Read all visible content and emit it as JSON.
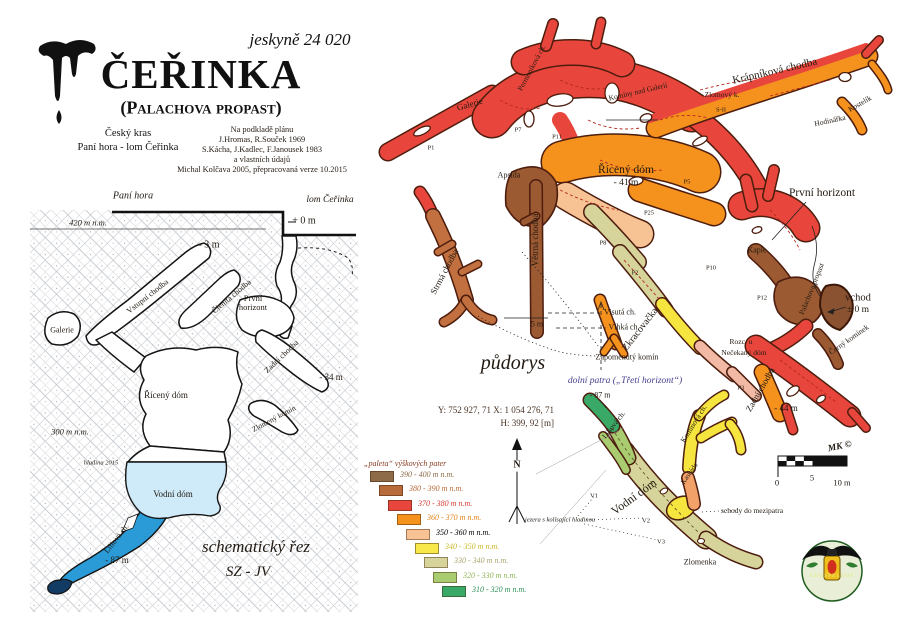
{
  "header": {
    "cave_number": "jeskyně 24 020",
    "title": "ČEŘINKA",
    "subtitle": "(Palachova propast)",
    "region": "Český kras\nPaní hora - lom Čeřinka",
    "credits": "Na podkladě plánu\nJ.Hromas, R.Souček 1969\nS.Kácha, J.Kadlec, F.Janousek 1983\na vlastních údajů\nMichal Kolčava 2005, přepracovaná verze 10.2015"
  },
  "section": {
    "labels": [
      {
        "text": "Paní hora",
        "x": 133,
        "y": 197,
        "size": 10,
        "italic": true
      },
      {
        "text": "lom Čeřinka",
        "x": 330,
        "y": 200,
        "size": 9.5,
        "italic": true
      },
      {
        "text": "420 m n.m.",
        "x": 88,
        "y": 223,
        "size": 8.5,
        "italic": true
      },
      {
        "text": "+ 0 m",
        "x": 304,
        "y": 222,
        "size": 10
      },
      {
        "text": "- 3 m",
        "x": 209,
        "y": 246,
        "size": 10
      },
      {
        "text": "Galerie",
        "x": 62,
        "y": 331,
        "size": 8
      },
      {
        "text": "Vstupní chodba",
        "x": 148,
        "y": 297,
        "size": 8,
        "rot": -38
      },
      {
        "text": "Členitá chodba",
        "x": 232,
        "y": 297,
        "size": 8,
        "rot": -40
      },
      {
        "text": "První\nhorizont",
        "x": 253,
        "y": 303,
        "size": 8.5
      },
      {
        "text": "Zadní chodba",
        "x": 282,
        "y": 357,
        "size": 8,
        "rot": -44
      },
      {
        "text": "- 34 m",
        "x": 331,
        "y": 378,
        "size": 9
      },
      {
        "text": "Řícený dóm",
        "x": 166,
        "y": 396,
        "size": 9
      },
      {
        "text": "300 m n.m.",
        "x": 70,
        "y": 432,
        "size": 8.5,
        "italic": true
      },
      {
        "text": "Zlomený komín",
        "x": 274,
        "y": 419,
        "size": 7.5,
        "rot": -28
      },
      {
        "text": "hladina 2015",
        "x": 101,
        "y": 463,
        "size": 6.5,
        "italic": true
      },
      {
        "text": "Vodní dóm",
        "x": 173,
        "y": 495,
        "size": 9
      },
      {
        "text": "Liliová ch.",
        "x": 117,
        "y": 539,
        "size": 8,
        "rot": -52
      },
      {
        "text": "- 87 m",
        "x": 117,
        "y": 561,
        "size": 9
      },
      {
        "text": "schematický řez",
        "x": 256,
        "y": 547,
        "size": 17,
        "italic": true,
        "name": "section-title"
      },
      {
        "text": "SZ - JV",
        "x": 248,
        "y": 572,
        "size": 15,
        "italic": true,
        "name": "section-orientation"
      }
    ]
  },
  "plan": {
    "labels": [
      {
        "text": "Krápníková chodba",
        "x": 775,
        "y": 72,
        "size": 11,
        "rot": -13
      },
      {
        "text": "Galerie",
        "x": 470,
        "y": 105,
        "size": 9,
        "rot": -16
      },
      {
        "text": "Permoníková ch.",
        "x": 532,
        "y": 68,
        "size": 7.5,
        "rot": -62
      },
      {
        "text": "Komíny nad Galerií",
        "x": 638,
        "y": 92,
        "size": 7.5,
        "rot": -13
      },
      {
        "text": "Zlomový k.",
        "x": 722,
        "y": 95,
        "size": 7.5
      },
      {
        "text": "Kostelík",
        "x": 860,
        "y": 104,
        "size": 7.5,
        "rot": -30
      },
      {
        "text": "Hodinářka",
        "x": 830,
        "y": 121,
        "size": 7.5,
        "rot": -12
      },
      {
        "text": "Řícený dóm",
        "x": 626,
        "y": 170,
        "size": 11.5
      },
      {
        "text": "- 41 m",
        "x": 626,
        "y": 183,
        "size": 9.5
      },
      {
        "text": "Apsida",
        "x": 509,
        "y": 176,
        "size": 8
      },
      {
        "text": "Větrná chodba",
        "x": 536,
        "y": 240,
        "size": 9,
        "rot": -90
      },
      {
        "text": "Strmá chodba",
        "x": 445,
        "y": 272,
        "size": 9,
        "rot": -62
      },
      {
        "text": "První horizont",
        "x": 822,
        "y": 193,
        "size": 11.5
      },
      {
        "text": "Kaple",
        "x": 757,
        "y": 251,
        "size": 8
      },
      {
        "text": "vchod",
        "x": 858,
        "y": 298,
        "size": 10.5
      },
      {
        "text": "± 0 m",
        "x": 858,
        "y": 310,
        "size": 9.5
      },
      {
        "text": "Palachova propast",
        "x": 812,
        "y": 289,
        "size": 7.5,
        "rot": -68
      },
      {
        "text": "Visutá ch.",
        "x": 620,
        "y": 313,
        "size": 8
      },
      {
        "text": "Vlhká ch.",
        "x": 624,
        "y": 328,
        "size": 8
      },
      {
        "text": "Zapomenutý komín",
        "x": 627,
        "y": 358,
        "size": 8
      },
      {
        "text": "Zkracovačka",
        "x": 641,
        "y": 330,
        "size": 10,
        "rot": -52
      },
      {
        "text": "Rozc. u",
        "x": 741,
        "y": 342,
        "size": 7.5
      },
      {
        "text": "Nečekaný dóm",
        "x": 744,
        "y": 353,
        "size": 7.5
      },
      {
        "text": "Zadní chodba",
        "x": 761,
        "y": 390,
        "size": 9,
        "rot": -60
      },
      {
        "text": "Černý komínek",
        "x": 849,
        "y": 340,
        "size": 7.5,
        "rot": -35
      },
      {
        "text": "- 44 m",
        "x": 786,
        "y": 409,
        "size": 9
      },
      {
        "text": "5 m",
        "x": 537,
        "y": 325,
        "size": 8
      },
      {
        "text": "půdorys",
        "x": 513,
        "y": 364,
        "size": 20,
        "italic": true,
        "name": "plan-title"
      }
    ],
    "markers": [
      {
        "text": "P1",
        "x": 431,
        "y": 148,
        "size": 6.5
      },
      {
        "text": "P7",
        "x": 518,
        "y": 130,
        "size": 6.5
      },
      {
        "text": "P11",
        "x": 557,
        "y": 137,
        "size": 6.5
      },
      {
        "text": "S-II",
        "x": 721,
        "y": 110,
        "size": 6.5
      },
      {
        "text": "P5",
        "x": 687,
        "y": 182,
        "size": 6.5
      },
      {
        "text": "P25",
        "x": 649,
        "y": 213,
        "size": 6.5
      },
      {
        "text": "P8",
        "x": 603,
        "y": 243,
        "size": 6.5
      },
      {
        "text": "P2",
        "x": 635,
        "y": 273,
        "size": 6.5
      },
      {
        "text": "P10",
        "x": 711,
        "y": 268,
        "size": 6.5
      },
      {
        "text": "P12",
        "x": 762,
        "y": 298,
        "size": 6.5
      },
      {
        "text": "P3",
        "x": 741,
        "y": 388,
        "size": 6.5
      }
    ]
  },
  "lower": {
    "labels": [
      {
        "text": "dolní patra („Třetí horizont“)",
        "x": 625,
        "y": 381,
        "size": 9.5,
        "italic": true,
        "color": "#46408e",
        "name": "lower-title"
      },
      {
        "text": "- 87 m",
        "x": 600,
        "y": 396,
        "size": 8
      },
      {
        "text": "Liliová ch.",
        "x": 614,
        "y": 425,
        "size": 7.5,
        "rot": -52
      },
      {
        "text": "Komínová ch.",
        "x": 694,
        "y": 424,
        "size": 7.5,
        "rot": -58
      },
      {
        "text": "Vodní dóm",
        "x": 634,
        "y": 497,
        "size": 12,
        "rot": -36
      },
      {
        "text": "Kaskáda",
        "x": 690,
        "y": 474,
        "size": 7,
        "rot": -55
      },
      {
        "text": "schody do mezipatra",
        "x": 752,
        "y": 511,
        "size": 7.5
      },
      {
        "text": "jezera s kolísající hladinou",
        "x": 560,
        "y": 520,
        "size": 6.5,
        "italic": true
      },
      {
        "text": "Zlomenka",
        "x": 700,
        "y": 563,
        "size": 8
      }
    ],
    "markers": [
      {
        "text": "V1",
        "x": 594,
        "y": 496,
        "size": 6.5
      },
      {
        "text": "V2",
        "x": 646,
        "y": 521,
        "size": 6.5
      },
      {
        "text": "V3",
        "x": 661,
        "y": 542,
        "size": 6.5
      }
    ]
  },
  "survey": {
    "coords": "Y: 752 927, 71    X: 1 054 276, 71",
    "elevation": "H: 399, 92 [m]"
  },
  "north": {
    "label": "N"
  },
  "legend": {
    "title": "„paleta“ výškových pater",
    "items": [
      {
        "range": "390 - 400 m n.m.",
        "color": "#8d6b48",
        "text_color": "#8d6b48"
      },
      {
        "range": "380 - 390 m n.m.",
        "color": "#b76a3a",
        "text_color": "#b76a3a"
      },
      {
        "range": "370 - 380 m n.m.",
        "color": "#e8463c",
        "text_color": "#d63a30"
      },
      {
        "range": "360 - 370 m n.m.",
        "color": "#f5921e",
        "text_color": "#e0851a"
      },
      {
        "range": "350 - 360 m n.m.",
        "color": "#f7c394",
        "text_color": "#e8a express05b"
      },
      {
        "range": "340 - 350 m n.m.",
        "color": "#f9e84a",
        "text_color": "#cdb82a"
      },
      {
        "range": "330 - 340 m n.m.",
        "color": "#d6d49a",
        "text_color": "#a8a66c"
      },
      {
        "range": "320 - 330 m n.m.",
        "color": "#a9cc70",
        "text_color": "#8fb656"
      },
      {
        "range": "310 - 320 m n.m.",
        "color": "#3aa968",
        "text_color": "#2f9158"
      }
    ]
  },
  "scalebar": {
    "zero": "0",
    "mid": "5",
    "end": "10 m",
    "credit": "MK ©"
  },
  "logo": {
    "text": "GEOSPELEOS"
  }
}
